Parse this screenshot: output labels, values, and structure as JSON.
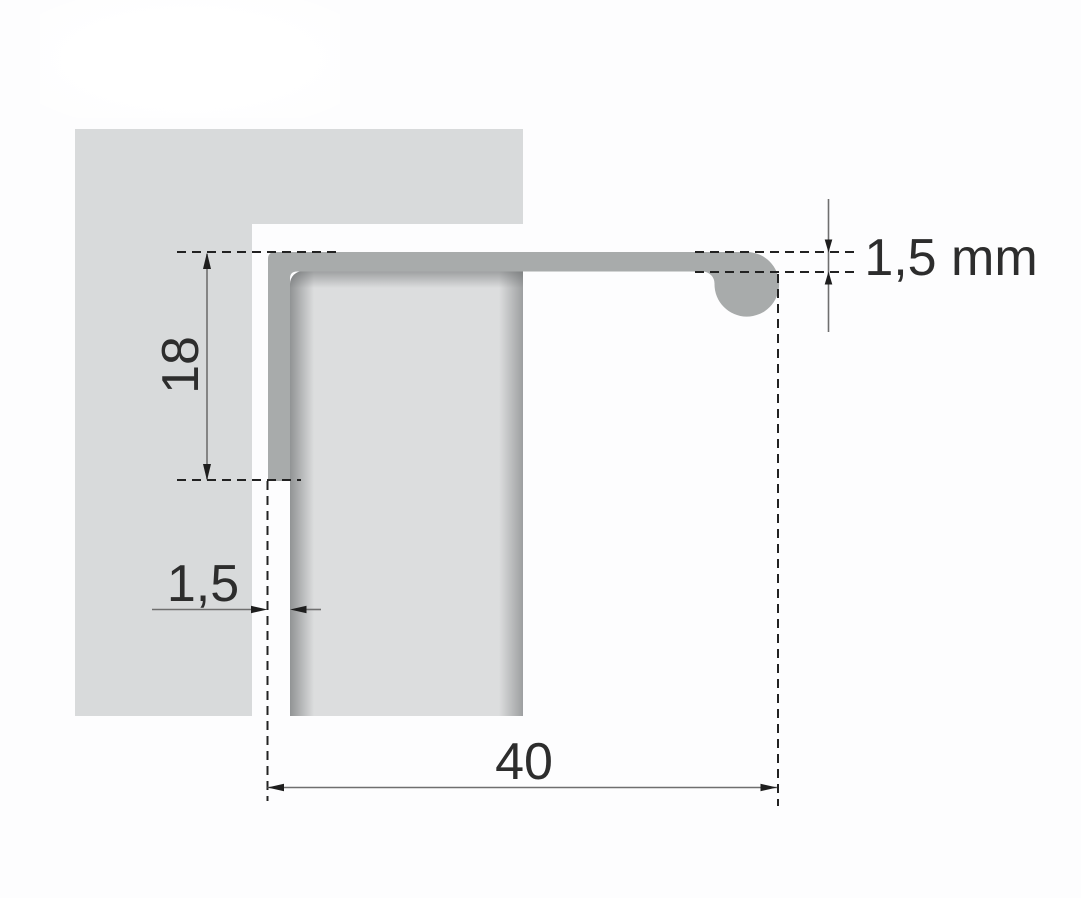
{
  "diagram": {
    "description": "Cross-section technical drawing of a recessed aluminium edge-pull handle profile mounted on the top edge of a furniture front panel",
    "labels": {
      "profile_height": "18",
      "front_leg_thickness": "1,5",
      "profile_width": "40",
      "material_thickness": "1,5 mm"
    }
  },
  "colors": {
    "background": "#fdfdfe",
    "cabinet_panel": "#d8dadb",
    "door_panel": "#dcddde",
    "profile": "#a8abab",
    "dashed_lines": "#222222",
    "dimension_lines": "#6f6f6f",
    "arrowheads": "#1e1e1e",
    "dimension_text": "#2d2d2d"
  }
}
